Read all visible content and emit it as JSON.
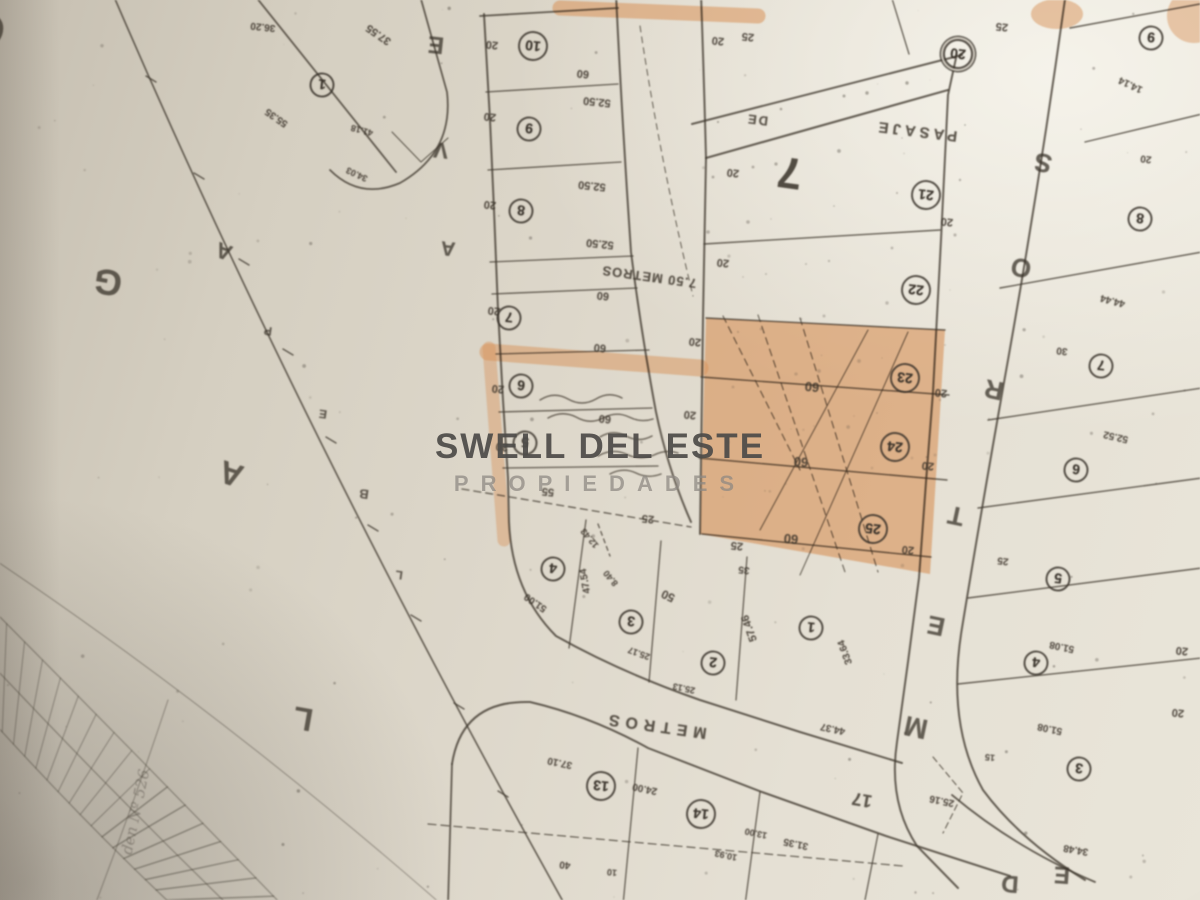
{
  "watermark": {
    "line1": "SWELL DEL ESTE",
    "line2": "PROPIEDADES"
  },
  "map": {
    "description": "cadastral-plot-plan-photo",
    "block_number": "7",
    "highlighted_lots": [
      "23",
      "24",
      "25"
    ],
    "colors": {
      "highlight": "#e09150",
      "ink": "#3b342b",
      "paper": "#ddd7ca"
    },
    "streets": {
      "west_avenue_letters": [
        "O",
        "G",
        "A",
        "L"
      ],
      "avenue_letters": [
        "E",
        "V",
        "A"
      ],
      "boundary_marker_letters": [
        "P",
        "E",
        "B",
        "L"
      ],
      "north_passage": "PASAJE DE",
      "cross_passage": "7.50 METROS",
      "east_street_letters": [
        "S",
        "O",
        "R",
        "T",
        "E",
        "M"
      ],
      "south_street": "METROS",
      "south_street_width": "17",
      "southeast_street_letters": [
        "D",
        "E"
      ]
    },
    "lots": [
      {
        "n": "1",
        "x": 322,
        "y": 85
      },
      {
        "n": "10",
        "x": 533,
        "y": 46
      },
      {
        "n": "9",
        "x": 529,
        "y": 129
      },
      {
        "n": "8",
        "x": 521,
        "y": 211
      },
      {
        "n": "7",
        "x": 509,
        "y": 318
      },
      {
        "n": "6",
        "x": 521,
        "y": 386
      },
      {
        "n": "5",
        "x": 525,
        "y": 443
      },
      {
        "n": "20",
        "x": 958,
        "y": 54,
        "dbl": true
      },
      {
        "n": "21",
        "x": 926,
        "y": 195
      },
      {
        "n": "22",
        "x": 916,
        "y": 290
      },
      {
        "n": "23",
        "x": 905,
        "y": 378
      },
      {
        "n": "24",
        "x": 895,
        "y": 447
      },
      {
        "n": "25",
        "x": 873,
        "y": 529
      },
      {
        "n": "9",
        "x": 1151,
        "y": 38
      },
      {
        "n": "8",
        "x": 1140,
        "y": 219
      },
      {
        "n": "7",
        "x": 1101,
        "y": 366
      },
      {
        "n": "6",
        "x": 1076,
        "y": 470
      },
      {
        "n": "5",
        "x": 1058,
        "y": 579
      },
      {
        "n": "4",
        "x": 1036,
        "y": 663
      },
      {
        "n": "3",
        "x": 1079,
        "y": 769
      },
      {
        "n": "4",
        "x": 553,
        "y": 569
      },
      {
        "n": "3",
        "x": 631,
        "y": 622
      },
      {
        "n": "2",
        "x": 713,
        "y": 663
      },
      {
        "n": "1",
        "x": 811,
        "y": 628
      },
      {
        "n": "13",
        "x": 601,
        "y": 786
      },
      {
        "n": "14",
        "x": 701,
        "y": 814
      }
    ],
    "labels": [
      {
        "t": "O",
        "x": -12,
        "y": 28,
        "r": 190,
        "s": 44,
        "k": "letter"
      },
      {
        "t": "G",
        "x": 108,
        "y": 282,
        "r": 190,
        "s": 36,
        "k": "letter"
      },
      {
        "t": "A",
        "x": 224,
        "y": 251,
        "r": 200,
        "s": 22,
        "k": "letter"
      },
      {
        "t": "A",
        "x": 231,
        "y": 474,
        "r": 198,
        "s": 32,
        "k": "letter"
      },
      {
        "t": "L",
        "x": 303,
        "y": 719,
        "r": 190,
        "s": 32,
        "k": "letter"
      },
      {
        "t": "P",
        "x": 268,
        "y": 331,
        "r": 188,
        "s": 12,
        "k": "letter"
      },
      {
        "t": "E",
        "x": 323,
        "y": 414,
        "r": 188,
        "s": 12,
        "k": "letter"
      },
      {
        "t": "B",
        "x": 364,
        "y": 494,
        "r": 188,
        "s": 13,
        "k": "letter"
      },
      {
        "t": "L",
        "x": 399,
        "y": 575,
        "r": 188,
        "s": 12,
        "k": "letter"
      },
      {
        "t": "E",
        "x": 436,
        "y": 44,
        "r": 186,
        "s": 24,
        "k": "letter"
      },
      {
        "t": "V",
        "x": 441,
        "y": 150,
        "r": 186,
        "s": 22,
        "k": "letter"
      },
      {
        "t": "A",
        "x": 448,
        "y": 248,
        "r": 186,
        "s": 20,
        "k": "letter"
      },
      {
        "t": "S",
        "x": 1043,
        "y": 163,
        "r": 192,
        "s": 26,
        "k": "letter"
      },
      {
        "t": "O",
        "x": 1021,
        "y": 268,
        "r": 192,
        "s": 26,
        "k": "letter"
      },
      {
        "t": "R",
        "x": 994,
        "y": 390,
        "r": 192,
        "s": 26,
        "k": "letter"
      },
      {
        "t": "T",
        "x": 956,
        "y": 516,
        "r": 192,
        "s": 26,
        "k": "letter"
      },
      {
        "t": "E",
        "x": 936,
        "y": 626,
        "r": 192,
        "s": 26,
        "k": "letter"
      },
      {
        "t": "M",
        "x": 916,
        "y": 727,
        "r": 192,
        "s": 28,
        "k": "letter"
      },
      {
        "t": "D",
        "x": 1010,
        "y": 883,
        "r": 184,
        "s": 24,
        "k": "letter"
      },
      {
        "t": "E",
        "x": 1062,
        "y": 874,
        "r": 184,
        "s": 24,
        "k": "letter"
      },
      {
        "t": "PASAJE",
        "x": 916,
        "y": 131,
        "r": 187,
        "s": 15,
        "ls": 4,
        "k": "street"
      },
      {
        "t": "DE",
        "x": 757,
        "y": 120,
        "r": 187,
        "s": 13,
        "ls": 2,
        "k": "street"
      },
      {
        "t": "7.50 METROS",
        "x": 649,
        "y": 277,
        "r": 188,
        "s": 13,
        "ls": 1,
        "k": "street"
      },
      {
        "t": "METROS",
        "x": 655,
        "y": 725,
        "r": 188,
        "s": 16,
        "ls": 6,
        "k": "street"
      },
      {
        "t": "17",
        "x": 862,
        "y": 800,
        "r": 190,
        "s": 18,
        "k": "street"
      },
      {
        "t": "7",
        "x": 790,
        "y": 172,
        "r": 188,
        "s": 44,
        "k": "blocknum"
      },
      {
        "t": "den Nº 526",
        "x": 136,
        "y": 812,
        "r": 282,
        "s": 15,
        "k": "note"
      },
      {
        "t": "20",
        "x": 492,
        "y": 44
      },
      {
        "t": "20",
        "x": 490,
        "y": 116
      },
      {
        "t": "20",
        "x": 490,
        "y": 204
      },
      {
        "t": "20",
        "x": 494,
        "y": 310
      },
      {
        "t": "20",
        "x": 498,
        "y": 388
      },
      {
        "t": "20",
        "x": 502,
        "y": 446
      },
      {
        "t": "60",
        "x": 583,
        "y": 73
      },
      {
        "t": "60",
        "x": 603,
        "y": 295
      },
      {
        "t": "60",
        "x": 600,
        "y": 347
      },
      {
        "t": "60",
        "x": 605,
        "y": 418
      },
      {
        "t": "52.50",
        "x": 597,
        "y": 101
      },
      {
        "t": "52.50",
        "x": 592,
        "y": 185
      },
      {
        "t": "52.50",
        "x": 600,
        "y": 243
      },
      {
        "t": "36.20",
        "x": 263,
        "y": 26,
        "s": 10
      },
      {
        "t": "37.55",
        "x": 379,
        "y": 34,
        "r": 215
      },
      {
        "t": "55.35",
        "x": 277,
        "y": 117,
        "r": 215,
        "s": 10
      },
      {
        "t": "41.18",
        "x": 362,
        "y": 130,
        "r": 195,
        "s": 9
      },
      {
        "t": "34.03",
        "x": 357,
        "y": 174,
        "r": 205,
        "s": 9
      },
      {
        "t": "20",
        "x": 718,
        "y": 40
      },
      {
        "t": "25",
        "x": 748,
        "y": 36
      },
      {
        "t": "25",
        "x": 1002,
        "y": 26
      },
      {
        "t": "14.14",
        "x": 1131,
        "y": 84,
        "r": 205,
        "s": 10
      },
      {
        "t": "20",
        "x": 1146,
        "y": 158,
        "s": 10
      },
      {
        "t": "20",
        "x": 733,
        "y": 172
      },
      {
        "t": "20",
        "x": 723,
        "y": 262
      },
      {
        "t": "20",
        "x": 695,
        "y": 341
      },
      {
        "t": "20",
        "x": 690,
        "y": 414
      },
      {
        "t": "20",
        "x": 947,
        "y": 221
      },
      {
        "t": "20",
        "x": 941,
        "y": 392
      },
      {
        "t": "20",
        "x": 928,
        "y": 465
      },
      {
        "t": "20",
        "x": 908,
        "y": 549
      },
      {
        "t": "60",
        "x": 812,
        "y": 387,
        "s": 13
      },
      {
        "t": "60",
        "x": 801,
        "y": 462,
        "s": 13
      },
      {
        "t": "60",
        "x": 791,
        "y": 539,
        "s": 13
      },
      {
        "t": "25",
        "x": 737,
        "y": 545
      },
      {
        "t": "35",
        "x": 744,
        "y": 569,
        "s": 10
      },
      {
        "t": "44.44",
        "x": 1113,
        "y": 300,
        "r": 195,
        "s": 10
      },
      {
        "t": "30",
        "x": 1062,
        "y": 350,
        "s": 10
      },
      {
        "t": "52.52",
        "x": 1116,
        "y": 436,
        "r": 193,
        "s": 10
      },
      {
        "t": "25",
        "x": 1003,
        "y": 560,
        "s": 10
      },
      {
        "t": "20",
        "x": 1182,
        "y": 650
      },
      {
        "t": "20",
        "x": 1178,
        "y": 712
      },
      {
        "t": "51.08",
        "x": 1062,
        "y": 646,
        "r": 192,
        "s": 10
      },
      {
        "t": "51.08",
        "x": 1050,
        "y": 728,
        "r": 192,
        "s": 10
      },
      {
        "t": "25.16",
        "x": 942,
        "y": 800,
        "r": 192,
        "s": 10
      },
      {
        "t": "34.48",
        "x": 1076,
        "y": 849,
        "r": 190,
        "s": 10
      },
      {
        "t": "15",
        "x": 990,
        "y": 757,
        "s": 9
      },
      {
        "t": "55",
        "x": 548,
        "y": 491
      },
      {
        "t": "25",
        "x": 648,
        "y": 518
      },
      {
        "t": "12.43",
        "x": 590,
        "y": 538,
        "r": 230,
        "s": 9
      },
      {
        "t": "47.54",
        "x": 586,
        "y": 581,
        "r": 260,
        "s": 10
      },
      {
        "t": "8.40",
        "x": 611,
        "y": 578,
        "r": 230,
        "s": 9
      },
      {
        "t": "51.00",
        "x": 536,
        "y": 602,
        "r": 215,
        "s": 10
      },
      {
        "t": "50",
        "x": 668,
        "y": 596,
        "r": 205,
        "s": 12
      },
      {
        "t": "25.17",
        "x": 639,
        "y": 653,
        "r": 200,
        "s": 9
      },
      {
        "t": "57.46",
        "x": 750,
        "y": 628,
        "r": 250,
        "s": 11
      },
      {
        "t": "25.13",
        "x": 684,
        "y": 688,
        "r": 192,
        "s": 9
      },
      {
        "t": "33.64",
        "x": 846,
        "y": 652,
        "r": 250,
        "s": 10
      },
      {
        "t": "44.37",
        "x": 833,
        "y": 728,
        "r": 192,
        "s": 10
      },
      {
        "t": "37.10",
        "x": 560,
        "y": 762,
        "r": 192,
        "s": 10
      },
      {
        "t": "24.00",
        "x": 645,
        "y": 788,
        "r": 192,
        "s": 10
      },
      {
        "t": "13.00",
        "x": 756,
        "y": 833,
        "r": 192,
        "s": 9
      },
      {
        "t": "10.93",
        "x": 726,
        "y": 855,
        "r": 192,
        "s": 9
      },
      {
        "t": "31.35",
        "x": 796,
        "y": 843,
        "r": 192,
        "s": 10
      },
      {
        "t": "40",
        "x": 565,
        "y": 864,
        "s": 10
      },
      {
        "t": "10",
        "x": 612,
        "y": 872,
        "s": 9
      }
    ]
  }
}
